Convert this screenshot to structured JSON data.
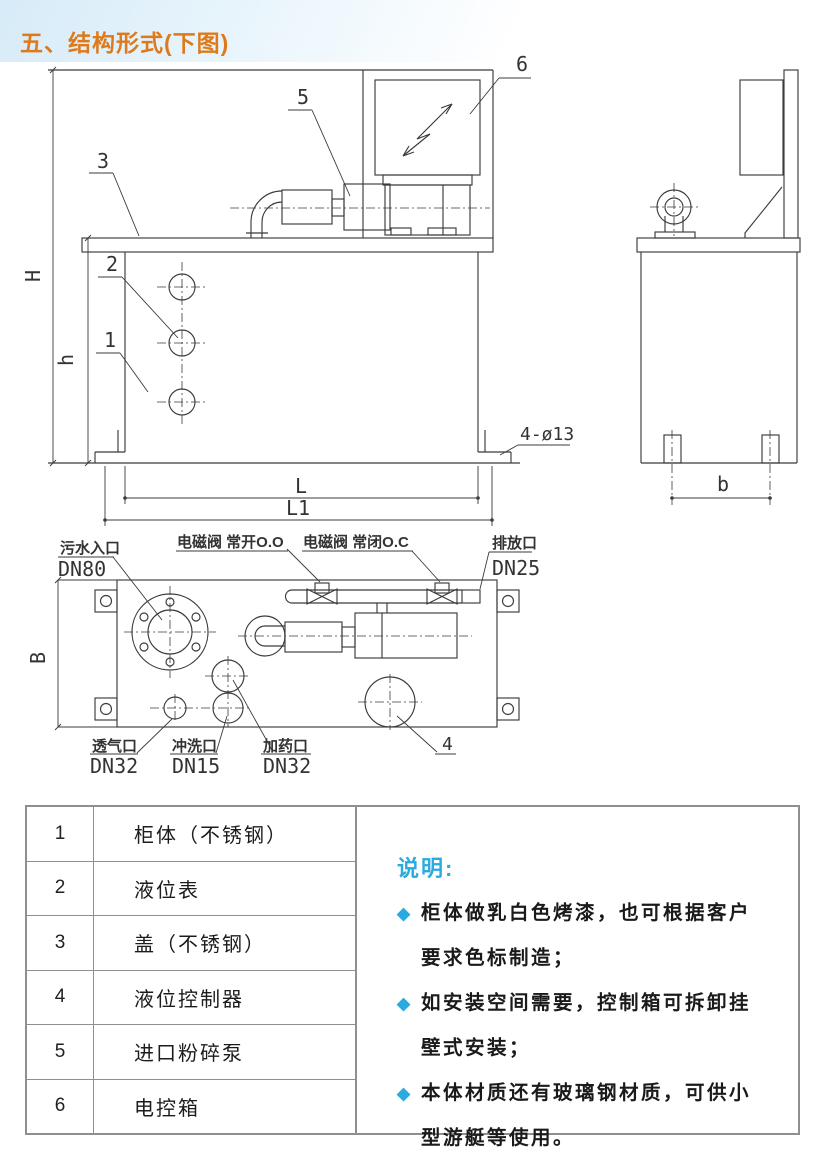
{
  "page": {
    "title": "五、结构形式(下图)"
  },
  "colors": {
    "accent_orange": "#de7a1c",
    "accent_cyan": "#29abe2",
    "line": "#3b3b3b"
  },
  "drawing": {
    "dims": {
      "H": "H",
      "h": "h",
      "L": "L",
      "L1": "L1",
      "b": "b",
      "B": "B",
      "hole_note": "4-ø13"
    },
    "callouts": {
      "c1": "1",
      "c2": "2",
      "c3": "3",
      "c4": "4",
      "c5": "5",
      "c6": "6"
    },
    "ports": {
      "inlet_name": "污水入口",
      "inlet_size": "DN80",
      "valve_open": "电磁阀 常开O.O",
      "valve_closed": "电磁阀 常闭O.C",
      "drain_name": "排放口",
      "drain_size": "DN25",
      "vent_name": "透气口",
      "vent_size": "DN32",
      "flush_name": "冲洗口",
      "flush_size": "DN15",
      "dosing_name": "加药口",
      "dosing_size": "DN32"
    }
  },
  "parts_table": {
    "rows": [
      {
        "no": "1",
        "name": "柜体（不锈钢）"
      },
      {
        "no": "2",
        "name": "液位表"
      },
      {
        "no": "3",
        "name": "盖（不锈钢）"
      },
      {
        "no": "4",
        "name": "液位控制器"
      },
      {
        "no": "5",
        "name": "进口粉碎泵"
      },
      {
        "no": "6",
        "name": "电控箱"
      }
    ]
  },
  "notes": {
    "heading": "说明:",
    "bullet_char": "◆",
    "items": [
      "柜体做乳白色烤漆，也可根据客户要求色标制造；",
      "如安装空间需要，控制箱可拆卸挂壁式安装；",
      "本体材质还有玻璃钢材质，可供小型游艇等使用。"
    ]
  }
}
